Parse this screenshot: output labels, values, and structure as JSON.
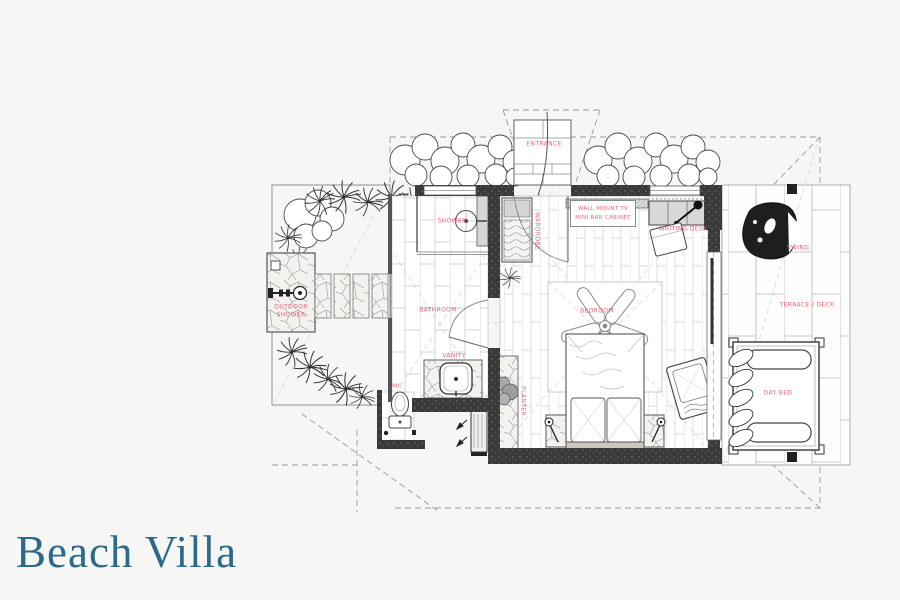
{
  "title": "Beach Villa",
  "colors": {
    "background": "#f6f7f5",
    "label_red": "#e2677a",
    "title_teal": "#2c6a8c",
    "wall_dark": "#3a3a3a"
  },
  "plan": {
    "labels": {
      "entrance": "ENTRANCE",
      "tv_line1": "WALL MOUNT TV",
      "tv_line2": "MINI BAR CABINET",
      "writing_desk": "WRITING DESK",
      "wardrobe": "WARDROBE",
      "bedroom": "BEDROOM",
      "shower": "SHOWER",
      "bathroom": "BATHROOM",
      "vanity": "VANITY",
      "wc": "WC",
      "outdoor_shower_line1": "OUTDOOR",
      "outdoor_shower_line2": "SHOWER",
      "planter": "PLANTER",
      "swing": "SWING",
      "terrace": "TERRACE / DECK",
      "day_bed": "DAY BED"
    }
  }
}
